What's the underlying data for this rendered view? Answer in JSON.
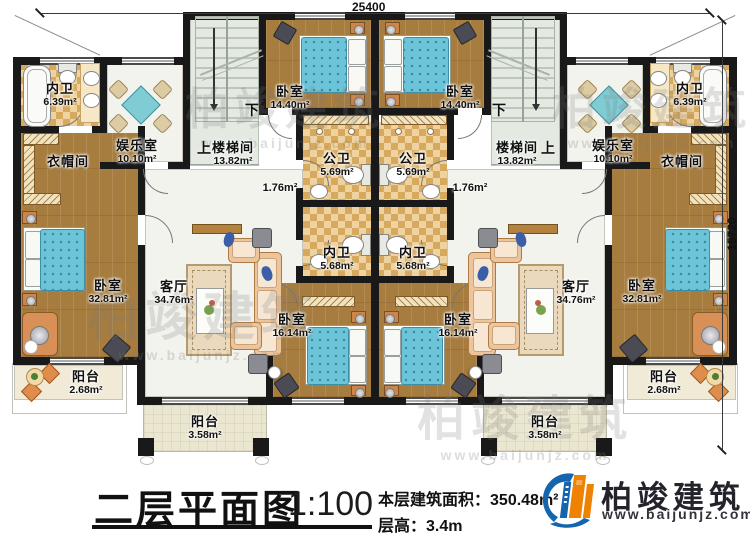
{
  "plan": {
    "dimension_top": "25400",
    "dimension_right": "15720"
  },
  "rooms": {
    "bath_top": {
      "name": "内卫",
      "area": "6.39m²"
    },
    "entertainment": {
      "name": "娱乐室",
      "area": "10.10m²"
    },
    "stairwell": {
      "name": "楼梯间",
      "area": "13.82m²"
    },
    "bedroom_top": {
      "name": "卧室",
      "area": "14.40m²"
    },
    "bath_public": {
      "name": "公卫",
      "area": "5.69m²"
    },
    "hall": {
      "area": "1.76m²"
    },
    "bath_mid": {
      "name": "内卫",
      "area": "5.68m²"
    },
    "bedroom_mid": {
      "name": "卧室",
      "area": "16.14m²"
    },
    "cloakroom": {
      "name": "衣帽间"
    },
    "bedroom_big": {
      "name": "卧室",
      "area": "32.81m²"
    },
    "living": {
      "name": "客厅",
      "area": "34.76m²"
    },
    "balcony_small": {
      "name": "阳台",
      "area": "2.68m²"
    },
    "balcony_big": {
      "name": "阳台",
      "area": "3.58m²"
    },
    "stairs_up": "上",
    "stairs_down": "下"
  },
  "titleblock": {
    "title": "二层平面图",
    "scale": "1:100",
    "area_label": "本层建筑面积：",
    "area_value": "350.48m²",
    "height_label": "层高：",
    "height_value": "3.4m"
  },
  "brand": {
    "name": "柏竣建筑",
    "url": "www.baijunjz.com"
  }
}
